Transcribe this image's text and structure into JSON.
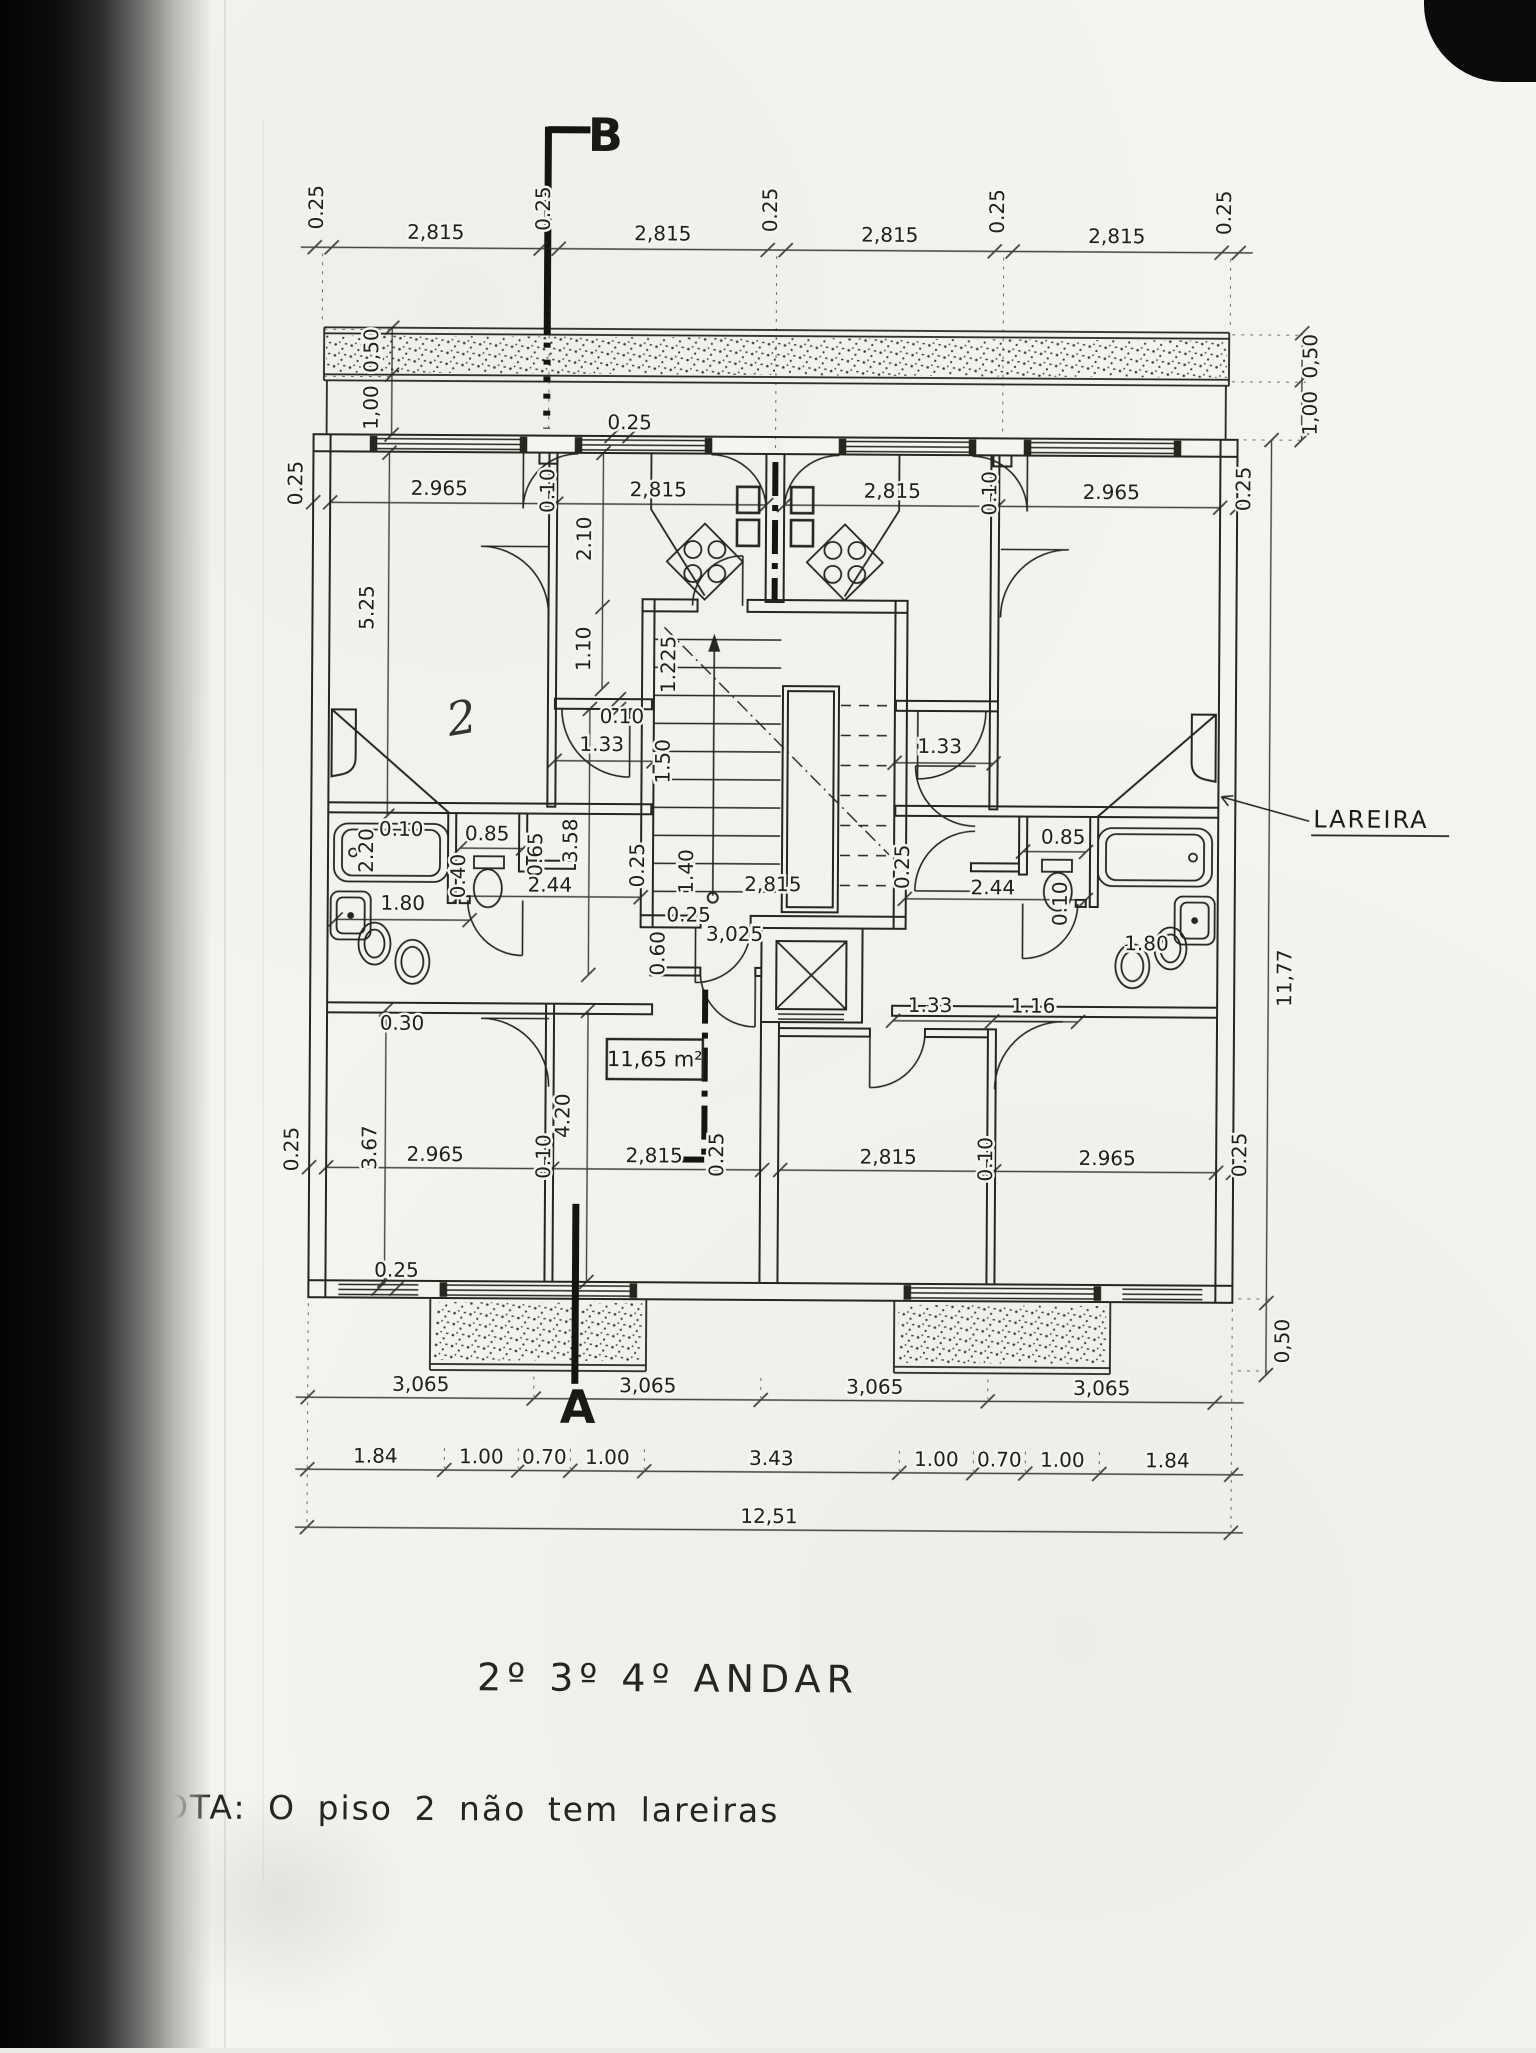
{
  "document": {
    "title": "2º 3º 4º ANDAR",
    "note": "NOTA: O  piso 2  não  tem  lareiras",
    "section_marker_top": "B",
    "section_marker_bottom": "A",
    "lareira_label": "LAREIRA",
    "area_label": "11,65 m²",
    "handwritten_mark": "2",
    "ink_color": "#23231e",
    "paper_color": "#f4f4f0"
  },
  "dimensions": [
    {
      "t": "0.25",
      "x": 318,
      "y": 210,
      "r": -90
    },
    {
      "t": "2,815",
      "x": 431,
      "y": 241
    },
    {
      "t": "0.25",
      "x": 545,
      "y": 210,
      "r": -90
    },
    {
      "t": "2,815",
      "x": 658,
      "y": 241
    },
    {
      "t": "0.25",
      "x": 772,
      "y": 210,
      "r": -90
    },
    {
      "t": "2,815",
      "x": 885,
      "y": 241
    },
    {
      "t": "0.25",
      "x": 999,
      "y": 210,
      "r": -90
    },
    {
      "t": "2,815",
      "x": 1112,
      "y": 241
    },
    {
      "t": "0.25",
      "x": 1226,
      "y": 210,
      "r": -90
    },
    {
      "t": "0,50",
      "x": 374,
      "y": 353,
      "r": -90
    },
    {
      "t": "1,00",
      "x": 374,
      "y": 410,
      "r": -90
    },
    {
      "t": "0,50",
      "x": 1313,
      "y": 353,
      "r": -90
    },
    {
      "t": "1,00",
      "x": 1313,
      "y": 410,
      "r": -90
    },
    {
      "t": "11,77",
      "x": 1291,
      "y": 975,
      "r": -90
    },
    {
      "t": "0,50",
      "x": 1291,
      "y": 1338,
      "r": -90
    },
    {
      "t": "0.25",
      "x": 299,
      "y": 486,
      "r": -90
    },
    {
      "t": "2.965",
      "x": 436,
      "y": 497
    },
    {
      "t": "0.10",
      "x": 551,
      "y": 492,
      "r": -90
    },
    {
      "t": "2,815",
      "x": 655,
      "y": 497
    },
    {
      "t": "2,815",
      "x": 889,
      "y": 497
    },
    {
      "t": "0.10",
      "x": 993,
      "y": 492,
      "r": -90
    },
    {
      "t": "2.965",
      "x": 1108,
      "y": 497
    },
    {
      "t": "0.25",
      "x": 1247,
      "y": 486,
      "r": -90
    },
    {
      "t": "0.25",
      "x": 626,
      "y": 430
    },
    {
      "t": "5.25",
      "x": 371,
      "y": 610,
      "r": -90
    },
    {
      "t": "2.10",
      "x": 588,
      "y": 540,
      "r": -90
    },
    {
      "t": "1.10",
      "x": 588,
      "y": 650,
      "r": -90
    },
    {
      "t": "0.10",
      "x": 620,
      "y": 724
    },
    {
      "t": "1.225",
      "x": 673,
      "y": 665,
      "r": -90
    },
    {
      "t": "1.50",
      "x": 668,
      "y": 762,
      "r": -90
    },
    {
      "t": "1.33",
      "x": 600,
      "y": 752
    },
    {
      "t": "3.58",
      "x": 576,
      "y": 842,
      "r": -90
    },
    {
      "t": "1.33",
      "x": 938,
      "y": 752
    },
    {
      "t": "0.10",
      "x": 400,
      "y": 838
    },
    {
      "t": "2.20",
      "x": 372,
      "y": 853,
      "r": -90
    },
    {
      "t": "0.85",
      "x": 486,
      "y": 842
    },
    {
      "t": "0.65",
      "x": 541,
      "y": 856,
      "r": -90
    },
    {
      "t": "0.40",
      "x": 464,
      "y": 878,
      "r": -90
    },
    {
      "t": "2.44",
      "x": 549,
      "y": 893
    },
    {
      "t": "1.80",
      "x": 402,
      "y": 912
    },
    {
      "t": "0.30",
      "x": 402,
      "y": 1032
    },
    {
      "t": "0.25",
      "x": 643,
      "y": 866,
      "r": -90
    },
    {
      "t": "1.40",
      "x": 692,
      "y": 872,
      "r": -90
    },
    {
      "t": "2,815",
      "x": 772,
      "y": 891
    },
    {
      "t": "0.25",
      "x": 908,
      "y": 866,
      "r": -90
    },
    {
      "t": "0.25",
      "x": 688,
      "y": 922
    },
    {
      "t": "0.60",
      "x": 664,
      "y": 954,
      "r": -90
    },
    {
      "t": "3,025",
      "x": 734,
      "y": 941
    },
    {
      "t": "0.85",
      "x": 1062,
      "y": 842
    },
    {
      "t": "0.10",
      "x": 1066,
      "y": 902,
      "r": -90
    },
    {
      "t": "2.44",
      "x": 992,
      "y": 893
    },
    {
      "t": "1.80",
      "x": 1146,
      "y": 948
    },
    {
      "t": "1.33",
      "x": 930,
      "y": 1011
    },
    {
      "t": "1.16",
      "x": 1033,
      "y": 1011
    },
    {
      "t": "4.20",
      "x": 570,
      "y": 1117,
      "r": -90
    },
    {
      "t": "3.67",
      "x": 377,
      "y": 1150,
      "r": -90
    },
    {
      "t": "0.25",
      "x": 724,
      "y": 1155,
      "r": -90
    },
    {
      "t": "0.25",
      "x": 299,
      "y": 1152,
      "r": -90
    },
    {
      "t": "2.965",
      "x": 436,
      "y": 1163
    },
    {
      "t": "0.10",
      "x": 551,
      "y": 1158,
      "r": -90
    },
    {
      "t": "2,815",
      "x": 655,
      "y": 1163
    },
    {
      "t": "2,815",
      "x": 889,
      "y": 1163
    },
    {
      "t": "0.10",
      "x": 993,
      "y": 1158,
      "r": -90
    },
    {
      "t": "2.965",
      "x": 1108,
      "y": 1163
    },
    {
      "t": "0.25",
      "x": 1247,
      "y": 1152,
      "r": -90
    },
    {
      "t": "0.25",
      "x": 398,
      "y": 1279
    },
    {
      "t": "3,065",
      "x": 423,
      "y": 1393
    },
    {
      "t": "3,065",
      "x": 650,
      "y": 1393
    },
    {
      "t": "3,065",
      "x": 877,
      "y": 1393
    },
    {
      "t": "3,065",
      "x": 1104,
      "y": 1393
    },
    {
      "t": "1.84",
      "x": 378,
      "y": 1465
    },
    {
      "t": "1.00",
      "x": 484,
      "y": 1465
    },
    {
      "t": "0.70",
      "x": 547,
      "y": 1465
    },
    {
      "t": "1.00",
      "x": 610,
      "y": 1465
    },
    {
      "t": "3.43",
      "x": 774,
      "y": 1465
    },
    {
      "t": "1.00",
      "x": 939,
      "y": 1465
    },
    {
      "t": "0.70",
      "x": 1002,
      "y": 1465
    },
    {
      "t": "1.00",
      "x": 1065,
      "y": 1465
    },
    {
      "t": "1.84",
      "x": 1170,
      "y": 1465
    },
    {
      "t": "12,51",
      "x": 772,
      "y": 1523
    }
  ]
}
